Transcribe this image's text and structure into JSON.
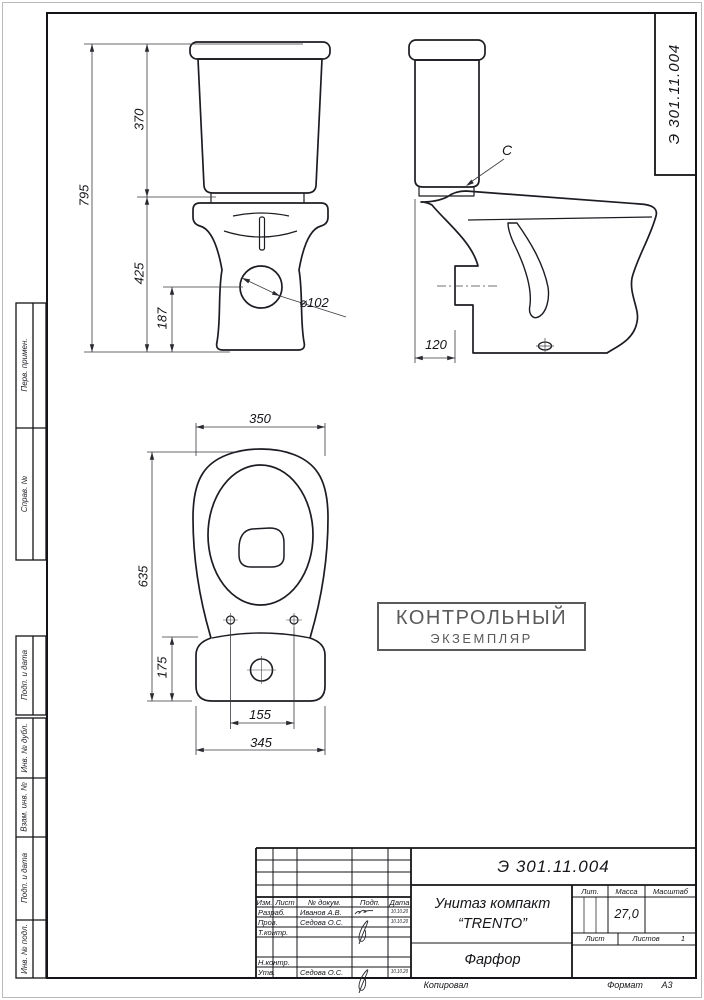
{
  "sheet": {
    "code": "Э 301.11.004",
    "stamp": {
      "line1": "КОНТРОЛЬНЫЙ",
      "line2": "ЭКЗЕМПЛЯР",
      "color": "#5a5a5a"
    },
    "footer": {
      "kopiroval": "Копировал",
      "format_label": "Формат",
      "format_value": "А3"
    }
  },
  "margin_labels": [
    "Перв. примен.",
    "Справ. №",
    "Подп. и дата",
    "Инв. № дубл.",
    "Взам. инв. №",
    "Подп. и дата",
    "Инв. № подл."
  ],
  "dims": {
    "front": {
      "total_height": "795",
      "tank_height": "370",
      "bowl_height": "425",
      "outlet_height": "187",
      "outlet_diameter": "⌀102"
    },
    "side": {
      "detail_label": "C",
      "depth": "120"
    },
    "top": {
      "bowl_width": "350",
      "total_length": "635",
      "tank_depth": "175",
      "bolt_spacing": "155",
      "tank_width": "345"
    }
  },
  "title_block": {
    "doc_number": "Э 301.11.004",
    "name_line1": "Унитаз компакт",
    "name_line2": "“TRENTO”",
    "material": "Фарфор",
    "mass": "27,0",
    "sheets_total": "1",
    "headers": {
      "izm": "Изм.",
      "list": "Лист",
      "doc": "№ докум.",
      "podp": "Подп.",
      "data": "Дата",
      "lit": "Лит.",
      "massa": "Масса",
      "masshtab": "Масштаб",
      "list2": "Лист",
      "listov": "Листов"
    },
    "rows": {
      "razrab": "Разраб.",
      "prov": "Пров.",
      "tkontr": "Т.контр.",
      "nkontr": "Н.контр.",
      "utv": "Утв."
    },
    "names": {
      "razrab": "Иванов А.В.",
      "prov": "Седова О.С.",
      "utv": "Седова О.С."
    },
    "dates": {
      "razrab": "10.10.20",
      "prov": "10.10.20",
      "utv": "10.10.20"
    }
  }
}
